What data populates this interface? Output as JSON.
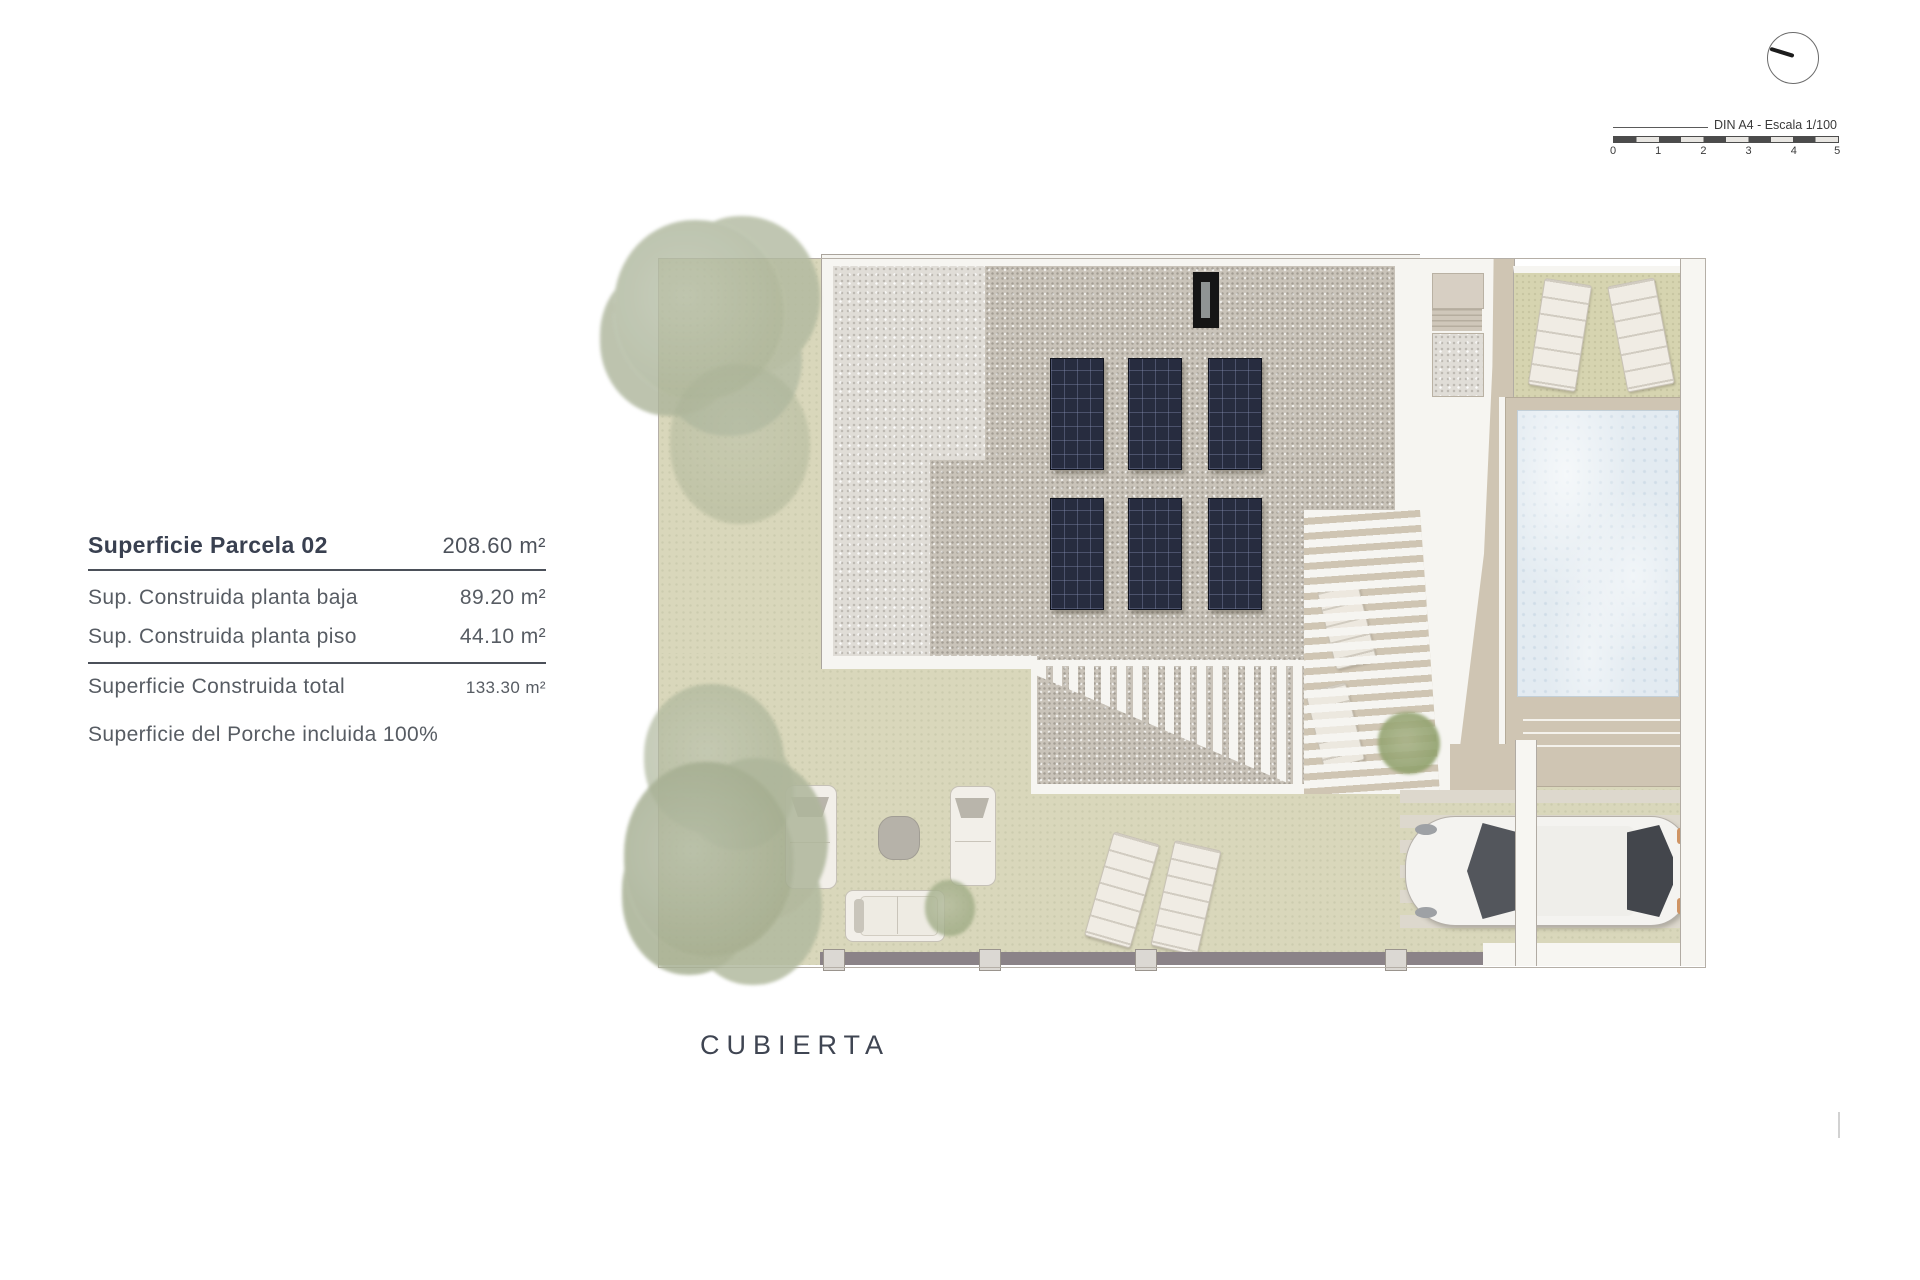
{
  "area_table": {
    "title_label": "Superficie Parcela 02",
    "title_value": "208.60 m²",
    "rows": [
      {
        "label": "Sup. Construida planta baja",
        "value": "89.20 m²"
      },
      {
        "label": "Sup. Construida planta piso",
        "value": "44.10 m²"
      }
    ],
    "total_label": "Superficie Construida total",
    "total_value": "133.30 m²",
    "note": "Superficie del Porche incluida 100%"
  },
  "scale_widget": {
    "label": "DIN A4 - Escala 1/100",
    "ticks": [
      "0",
      "1",
      "2",
      "3",
      "4",
      "5"
    ]
  },
  "plan_label": "CUBIERTA",
  "plan": {
    "colors": {
      "lawn": "#d9d7bb",
      "gravel_light": "#e0ddd7",
      "gravel_dark": "#c9c3b9",
      "solar_panel": "#272c3f",
      "pool_water": "#e3ebf1",
      "deck_tan": "#cfc5b3",
      "white_band": "#f6f5f1",
      "fence": "#8b8388",
      "text": "#3f4552"
    }
  }
}
